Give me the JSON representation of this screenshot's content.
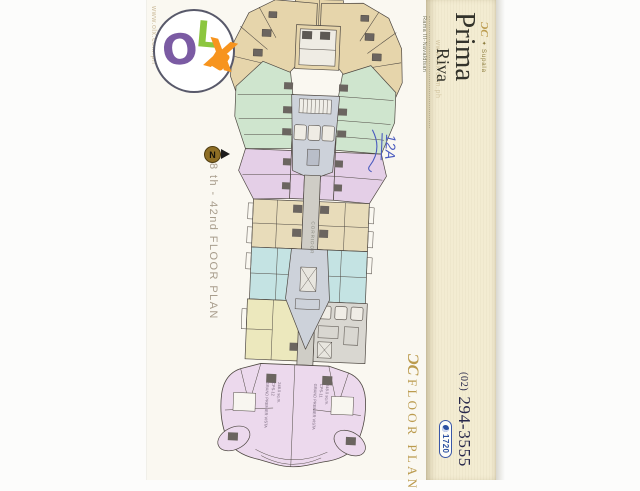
{
  "watermarks": {
    "left_url": "www.olx.com.ph",
    "right_url": "www.olx.com.ph"
  },
  "olx_logo": {
    "o": "O",
    "l": "L",
    "x": "X"
  },
  "floor_plan": {
    "compass_letter": "N",
    "range_label": "8 th - 42nd FLOOR PLAN",
    "corridor_label": "CORRIDOR",
    "handwritten_note": "12A",
    "bottom_units": {
      "left": {
        "name": "GRAND PREMIER VISTA",
        "code": "CPS-12",
        "area": "248.0 sq.m."
      },
      "right": {
        "name": "GRAND PREMIER VISTA",
        "code": "CPS-11",
        "area": "248.0 sq.m."
      }
    },
    "colors": {
      "tan": "#e6d5ab",
      "green": "#cfe5ce",
      "pink": "#e4cfe7",
      "cyan": "#c4e3e3",
      "yellow": "#ece8bd",
      "gray_core": "#cdd2da",
      "corridor": "#cfcdc6",
      "pink_fan": "#ecd9ed",
      "ink": "#4e4842",
      "note_blue": "#4a5bbf"
    }
  },
  "brand_panel": {
    "logo_monogram": "ƆC",
    "tagline": "✦ Supala",
    "name_line1": "Prima",
    "name_line2": "Riva",
    "subtitle": "Rama III-Navaldisan",
    "phone_area": "(02)",
    "phone_number": "294-3555",
    "badge": "1720"
  },
  "footer": {
    "logo_monogram": "ƆC",
    "label": "FLOOR PLAN"
  }
}
